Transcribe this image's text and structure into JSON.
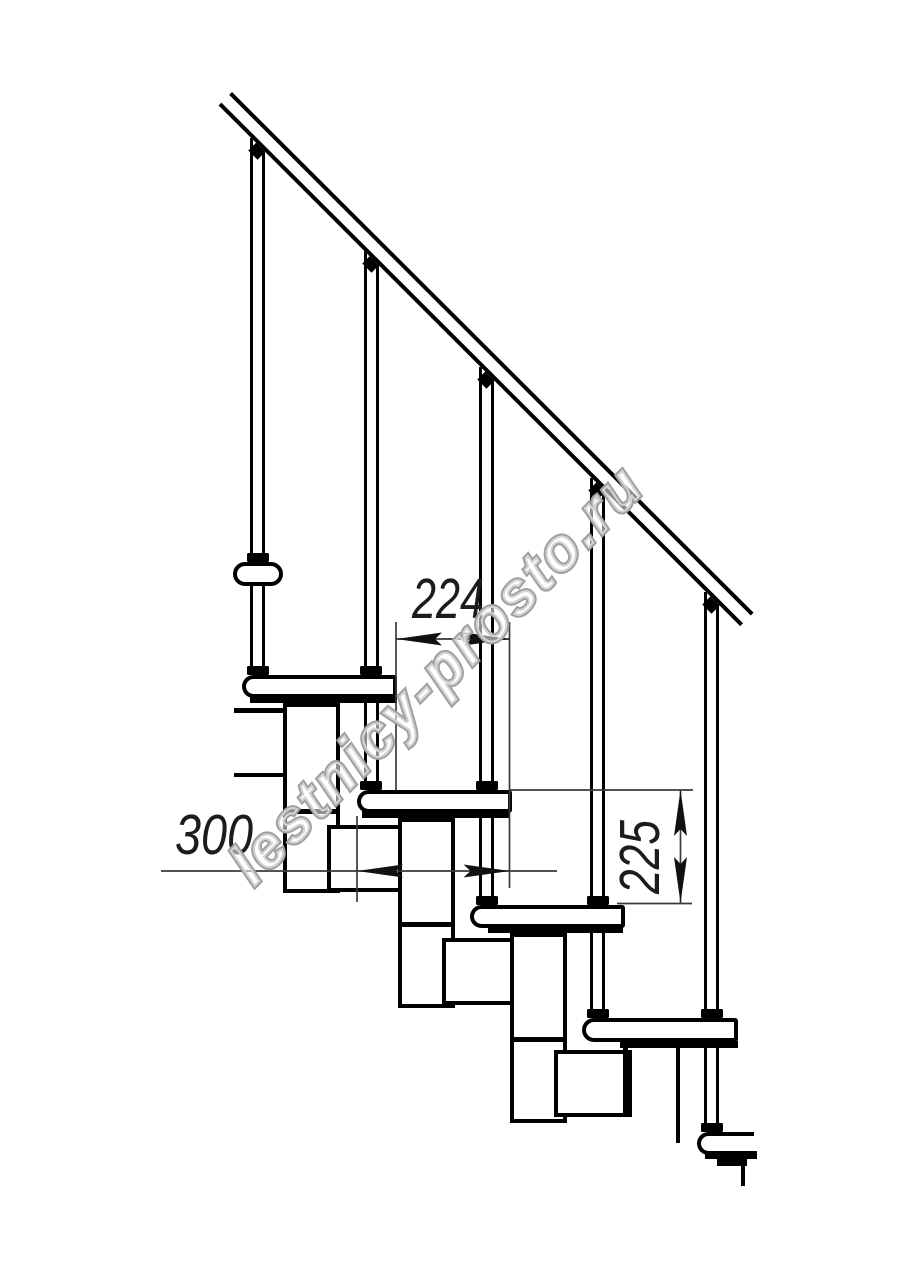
{
  "drawing": {
    "watermark_text": "lestnicy-prosto.ru",
    "dimensions": {
      "step_run_mm": "224",
      "tread_depth_mm": "300",
      "riser_height_mm": "225"
    },
    "colors": {
      "line": "#000000",
      "dimension_line": "#3a3a3a",
      "watermark_outline": "#a0a0a0"
    }
  }
}
